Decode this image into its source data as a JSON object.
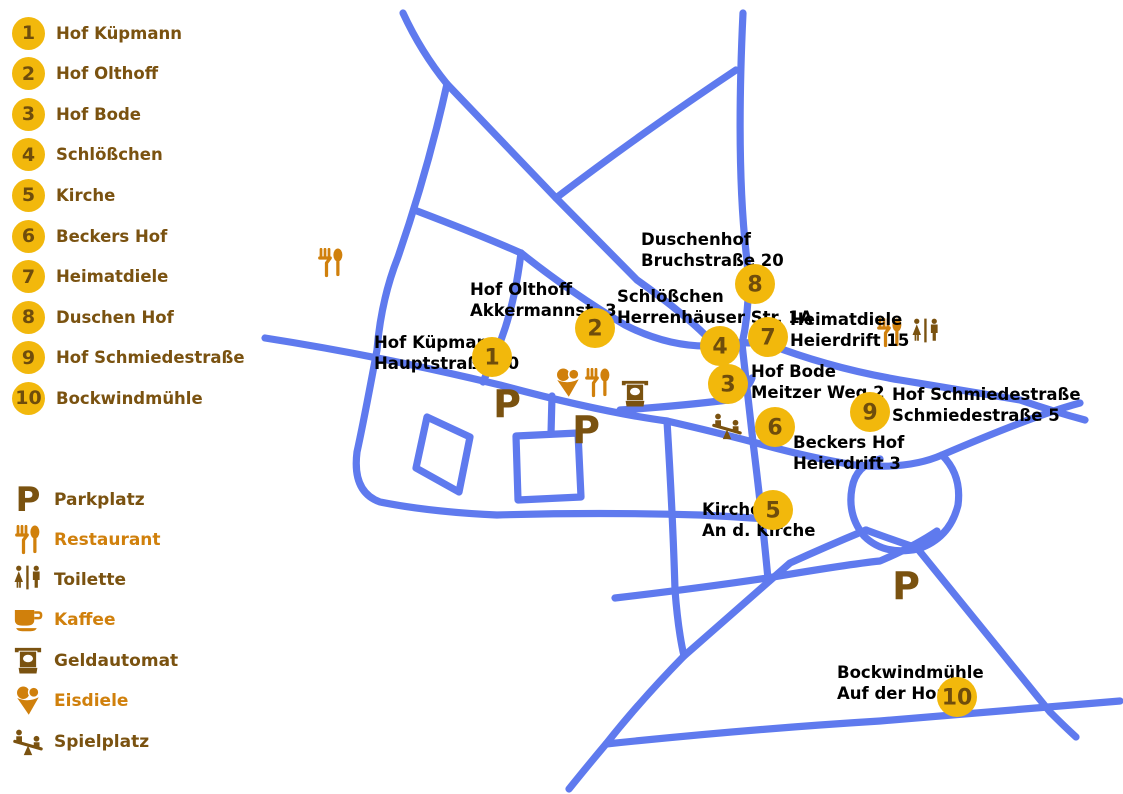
{
  "colors": {
    "road": "#5F7AEE",
    "gold": "#F2B80C",
    "marker_number": "#6F4D0C",
    "brown": "#7A5210",
    "orange": "#D0800C",
    "label": "#000000",
    "background": "#FFFFFF"
  },
  "sidebar": {
    "items": [
      {
        "number": "1",
        "label": "Hof Küpmann"
      },
      {
        "number": "2",
        "label": "Hof Olthoff"
      },
      {
        "number": "3",
        "label": "Hof Bode"
      },
      {
        "number": "4",
        "label": "Schlößchen"
      },
      {
        "number": "5",
        "label": "Kirche"
      },
      {
        "number": "6",
        "label": "Beckers Hof"
      },
      {
        "number": "7",
        "label": "Heimatdiele"
      },
      {
        "number": "8",
        "label": "Duschen Hof"
      },
      {
        "number": "9",
        "label": "Hof Schmiedestraße"
      },
      {
        "number": "10",
        "label": "Bockwindmühle"
      }
    ]
  },
  "legend": {
    "parking_glyph": "P",
    "items": [
      {
        "icon": "parking-icon",
        "label": "Parkplatz",
        "color": "brown"
      },
      {
        "icon": "restaurant-icon",
        "label": "Restaurant",
        "color": "orange"
      },
      {
        "icon": "toilet-icon",
        "label": "Toilette",
        "color": "brown"
      },
      {
        "icon": "coffee-icon",
        "label": "Kaffee",
        "color": "orange"
      },
      {
        "icon": "atm-icon",
        "label": "Geldautomat",
        "color": "brown"
      },
      {
        "icon": "icecream-icon",
        "label": "Eisdiele",
        "color": "orange"
      },
      {
        "icon": "playground-icon",
        "label": "Spielplatz",
        "color": "brown"
      }
    ]
  },
  "map": {
    "parking_glyph": "P",
    "markers": [
      {
        "number": "1",
        "x": 492,
        "y": 357
      },
      {
        "number": "2",
        "x": 595,
        "y": 328
      },
      {
        "number": "3",
        "x": 728,
        "y": 384
      },
      {
        "number": "4",
        "x": 720,
        "y": 346
      },
      {
        "number": "5",
        "x": 773,
        "y": 510
      },
      {
        "number": "6",
        "x": 775,
        "y": 427
      },
      {
        "number": "7",
        "x": 768,
        "y": 337
      },
      {
        "number": "8",
        "x": 755,
        "y": 284
      },
      {
        "number": "9",
        "x": 870,
        "y": 412
      },
      {
        "number": "10",
        "x": 957,
        "y": 697
      }
    ],
    "labels": [
      {
        "lines": [
          "Hof Küpmann",
          "Hauptstraße 70"
        ],
        "x": 374,
        "y": 348
      },
      {
        "lines": [
          "Hof Olthoff",
          "Akkermannst. 3"
        ],
        "x": 470,
        "y": 295
      },
      {
        "lines": [
          "Schlößchen",
          "Herrenhäuser Str. 1A"
        ],
        "x": 617,
        "y": 302
      },
      {
        "lines": [
          "Duschenhof",
          "Bruchstraße 20"
        ],
        "x": 641,
        "y": 245
      },
      {
        "lines": [
          "Heimatdiele",
          "Heierdrift 15"
        ],
        "x": 790,
        "y": 325
      },
      {
        "lines": [
          "Hof Bode",
          "Meitzer Weg 2"
        ],
        "x": 751,
        "y": 377
      },
      {
        "lines": [
          "Beckers Hof",
          "Heierdrift 3"
        ],
        "x": 793,
        "y": 448
      },
      {
        "lines": [
          "Hof Schmiedestraße",
          "Schmiedestraße 5"
        ],
        "x": 892,
        "y": 400
      },
      {
        "lines": [
          "Kirche",
          "An d. Kirche"
        ],
        "x": 702,
        "y": 515
      },
      {
        "lines": [
          "Bockwindmühle",
          "Auf der Horst"
        ],
        "x": 837,
        "y": 678
      }
    ],
    "poi_icons": [
      {
        "icon": "restaurant-icon",
        "x": 331,
        "y": 263,
        "color": "orange"
      },
      {
        "icon": "icecream-icon",
        "x": 568,
        "y": 383,
        "color": "orange"
      },
      {
        "icon": "restaurant-icon",
        "x": 598,
        "y": 383,
        "color": "orange"
      },
      {
        "icon": "atm-icon",
        "x": 635,
        "y": 394,
        "color": "brown"
      },
      {
        "icon": "restaurant-icon",
        "x": 890,
        "y": 333,
        "color": "orange"
      },
      {
        "icon": "toilet-icon",
        "x": 926,
        "y": 333,
        "color": "brown"
      },
      {
        "icon": "playground-icon",
        "x": 727,
        "y": 426,
        "color": "brown"
      }
    ],
    "parking_marks": [
      {
        "x": 507,
        "y": 404
      },
      {
        "x": 586,
        "y": 430
      },
      {
        "x": 906,
        "y": 586
      }
    ],
    "roads": [
      "M403,13 Q421,52 447,84",
      "M447,84 L556,198 L637,280 Q688,316 715,345",
      "M736,70 Q640,134 556,198",
      "M743,13 Q736,160 746,252 Q752,300 742,344 L753,442 Q762,515 768,579",
      "M265,338 Q380,356 500,385 Q600,412 667,421 Q715,432 753,442",
      "M447,84 Q428,170 398,257 Q381,300 377,350 Q364,420 357,452 Q352,492 380,502 Q430,512 497,515 Q600,512 700,515 Q740,517 766,519",
      "M417,211 Q480,235 521,253",
      "M521,253 Q570,292 625,325 Q668,347 710,346",
      "M521,253 Q514,310 497,350 L483,382",
      "M620,410 Q680,406 728,400 Q748,390 752,378",
      "M667,421 Q673,520 675,590 Q678,630 684,656",
      "M710,345 Q741,341 768,344 Q830,368 900,380 Q985,394 1020,400 Q1055,412 1085,420",
      "M753,442 Q810,458 855,465 Q908,470 942,455 Q1005,428 1045,414 Q1065,407 1080,403",
      "M942,455 Q962,475 958,505 Q950,538 918,549 Q884,556 864,536 Q847,515 852,488 Q856,465 880,459",
      "M615,598 Q700,588 767,578 Q850,564 880,561 Q915,546 937,531",
      "M866,530 Q893,540 917,548 Q985,632 1050,712 Q1064,726 1076,737",
      "M866,530 Q825,547 790,563 Q735,611 684,656 Q640,701 606,744 Q585,769 569,789",
      "M606,744 Q750,729 880,721 Q1000,711 1048,707 L1120,701",
      "M427,417 L470,437 L459,492 L416,468 Z",
      "M516,436 L578,433 L581,497 L518,500 Z",
      "M552,396 L551,434"
    ]
  }
}
